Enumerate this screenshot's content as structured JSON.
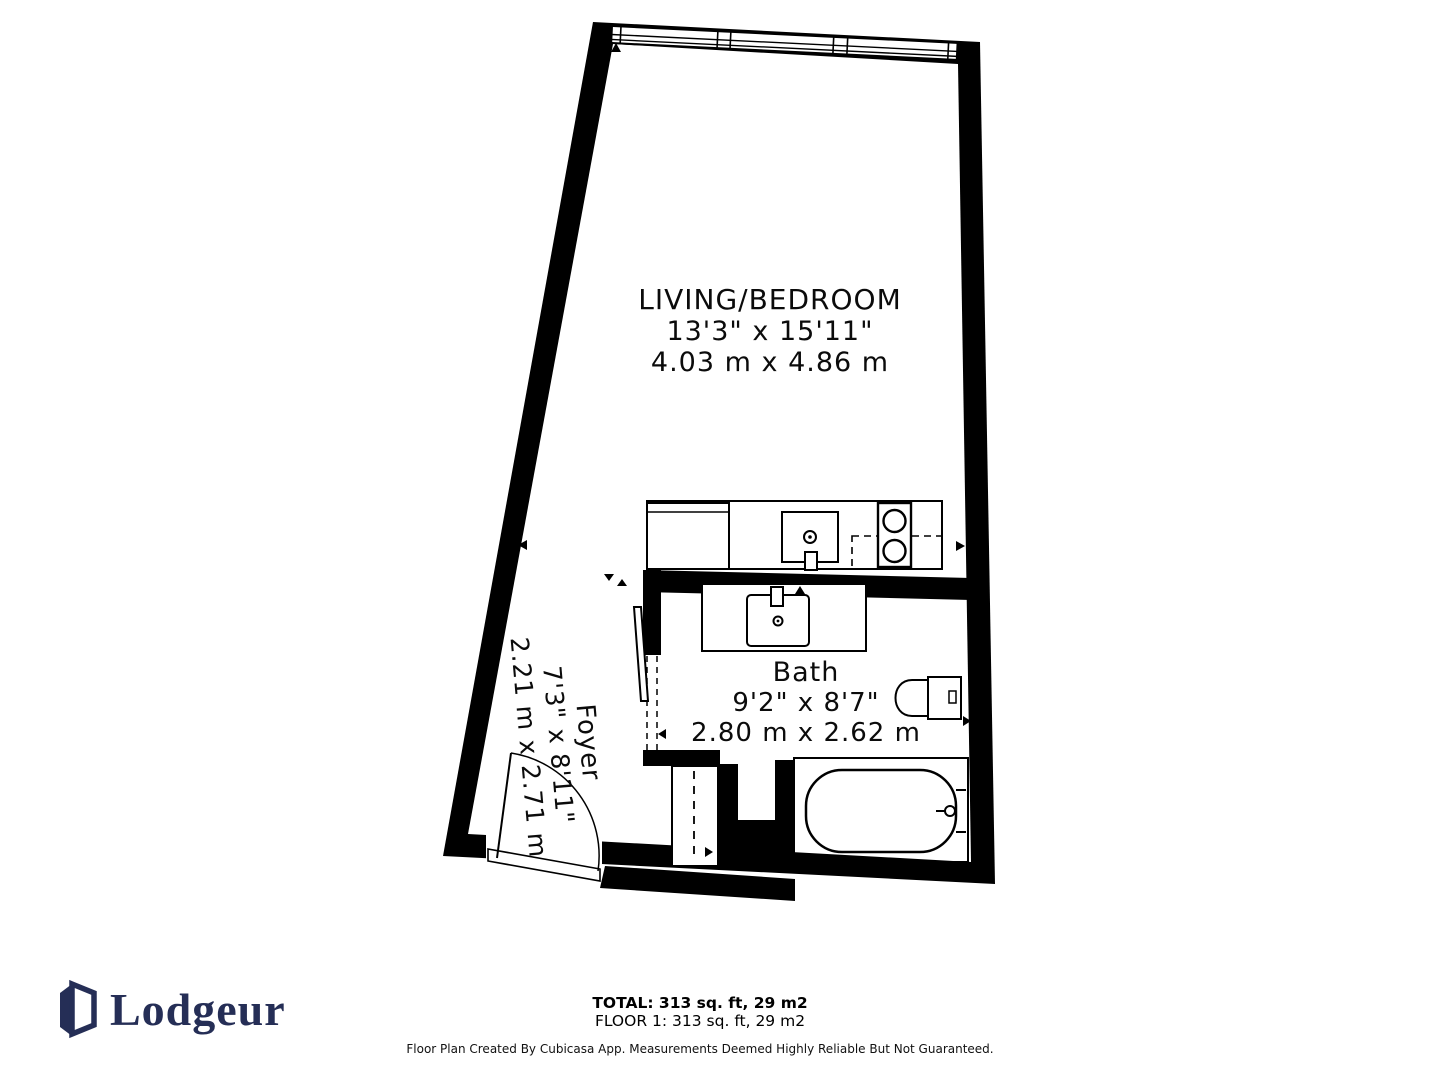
{
  "plan": {
    "rooms": [
      {
        "name": "LIVING/BEDROOM",
        "dims_imperial": "13'3\" x 15'11\"",
        "dims_metric": "4.03 m x 4.86 m"
      },
      {
        "name": "Bath",
        "dims_imperial": "9'2\" x 8'7\"",
        "dims_metric": "2.80 m x 2.62 m"
      },
      {
        "name": "Foyer",
        "dims_imperial": "7'3\" x 8'11\"",
        "dims_metric": "2.21 m x 2.71 m"
      }
    ],
    "fixtures": [
      "windows",
      "fridge",
      "kitchen-sink",
      "stove",
      "dishwasher",
      "vanity-sink",
      "toilet",
      "bathtub",
      "entry-door",
      "sliding-door",
      "closet"
    ],
    "wall_color": "#000000",
    "floor_color": "#ffffff"
  },
  "summary": {
    "total": "TOTAL: 313 sq. ft, 29 m2",
    "floor": "FLOOR 1: 313 sq. ft, 29 m2"
  },
  "branding": {
    "name": "Lodgeur",
    "color": "#252e56"
  },
  "footer": {
    "disclaimer": "Floor Plan Created By Cubicasa App. Measurements Deemed Highly Reliable But Not Guaranteed."
  }
}
